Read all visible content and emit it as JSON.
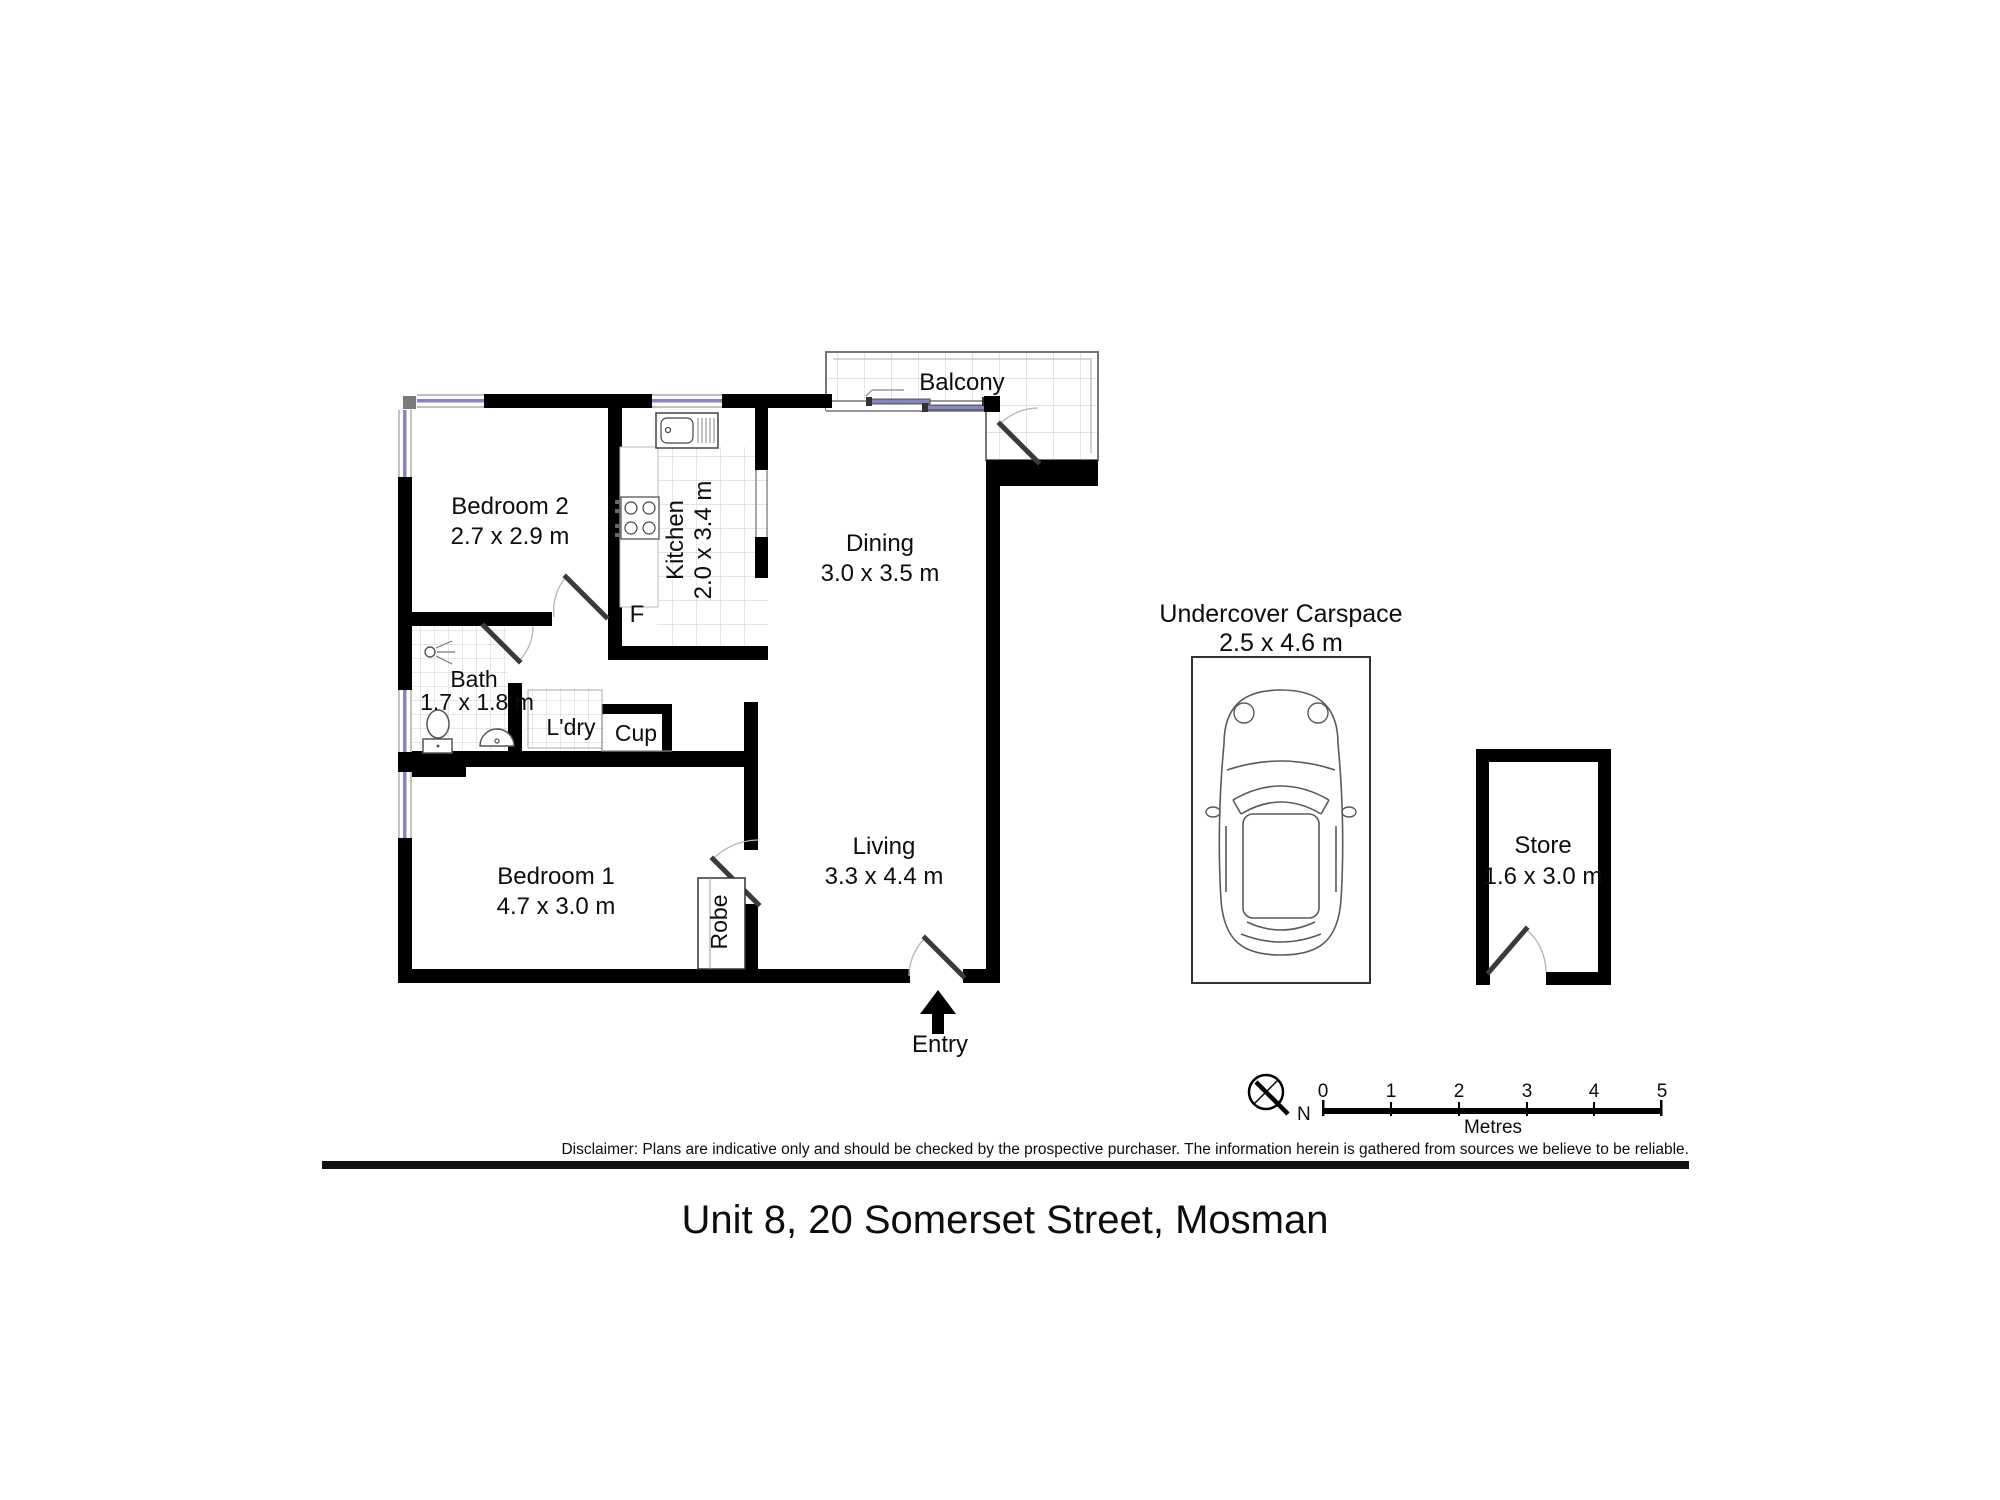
{
  "title": "Unit 8, 20 Somerset Street, Mosman",
  "footer": {
    "disclaimer": "Disclaimer: Plans are indicative only and should be checked by the prospective purchaser. The information herein is gathered from sources we believe to be reliable."
  },
  "plan": {
    "balcony": {
      "label": "Balcony"
    },
    "bedroom2": {
      "label": "Bedroom 2",
      "dims": "2.7 x 2.9 m"
    },
    "kitchen": {
      "label": "Kitchen",
      "dims": "2.0 x 3.4 m"
    },
    "fridge": {
      "label": "F"
    },
    "dining": {
      "label": "Dining",
      "dims": "3.0 x 3.5 m"
    },
    "bath": {
      "label": "Bath",
      "dims": "1.7 x 1.8 m"
    },
    "laundry": {
      "label": "L'dry"
    },
    "cupboard": {
      "label": "Cup"
    },
    "bedroom1": {
      "label": "Bedroom 1",
      "dims": "4.7 x 3.0 m"
    },
    "robe": {
      "label": "Robe"
    },
    "living": {
      "label": "Living",
      "dims": "3.3 x 4.4 m"
    },
    "entry": {
      "label": "Entry"
    }
  },
  "outbuildings": {
    "carspace": {
      "label": "Undercover Carspace",
      "dims": "2.5 x 4.6 m"
    },
    "store": {
      "label": "Store",
      "dims": "1.6 x 3.0 m"
    }
  },
  "compass": {
    "north": "N"
  },
  "scalebar": {
    "ticks": [
      "0",
      "1",
      "2",
      "3",
      "4",
      "5"
    ],
    "unit": "Metres"
  },
  "colors": {
    "wall": "#000000",
    "window": "#8585c2",
    "door_leaf": "#3a3a3a",
    "tile_line": "#cccccc"
  }
}
